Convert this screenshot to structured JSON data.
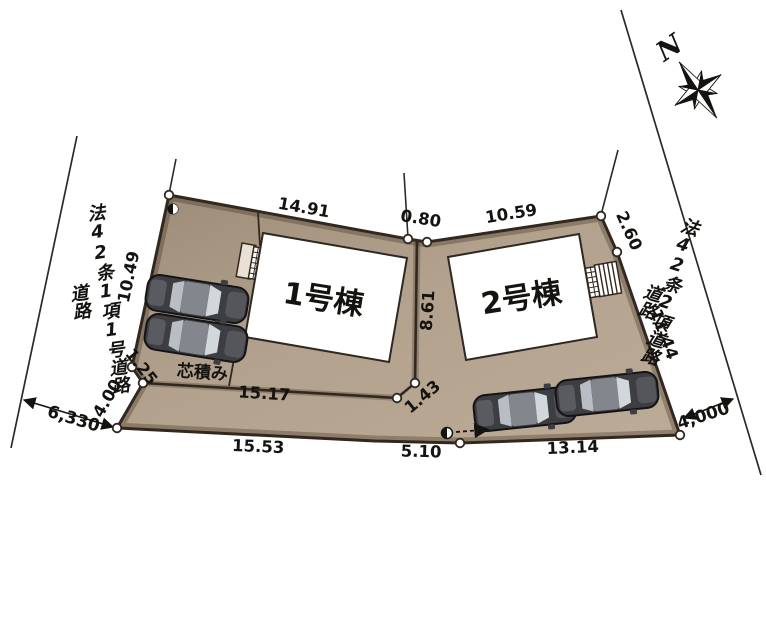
{
  "compass": {
    "north": "N"
  },
  "roads": {
    "left": {
      "name": "法42条1項1号道路",
      "area_label": "道路",
      "width": "6,330"
    },
    "right": {
      "name": "法42条2項道路",
      "area_label": "道路",
      "width": "4,000"
    }
  },
  "buildings": {
    "b1": "1号棟",
    "b2": "2号棟"
  },
  "labels": {
    "wall": "芯積み"
  },
  "dims": {
    "lot1_top": "14.91",
    "top_gap": "0.80",
    "lot2_top": "10.59",
    "right_upper": "2.60",
    "right_lower": "11.44",
    "left_upper": "10.49",
    "left_step": "1.25",
    "left_lower": "4.00",
    "divider_vertical": "8.61",
    "divider_step": "1.43",
    "divider_bottom": "15.17",
    "bottom_left": "15.53",
    "bottom_center": "5.10",
    "bottom_right": "13.14"
  },
  "colors": {
    "site_fill": "#b3a28f",
    "site_fill_dark": "#9e8d79",
    "outline": "#33281e",
    "building_fill": "#ffffff",
    "car_body": "#3d3e42",
    "car_window": "#d2d7dc"
  }
}
